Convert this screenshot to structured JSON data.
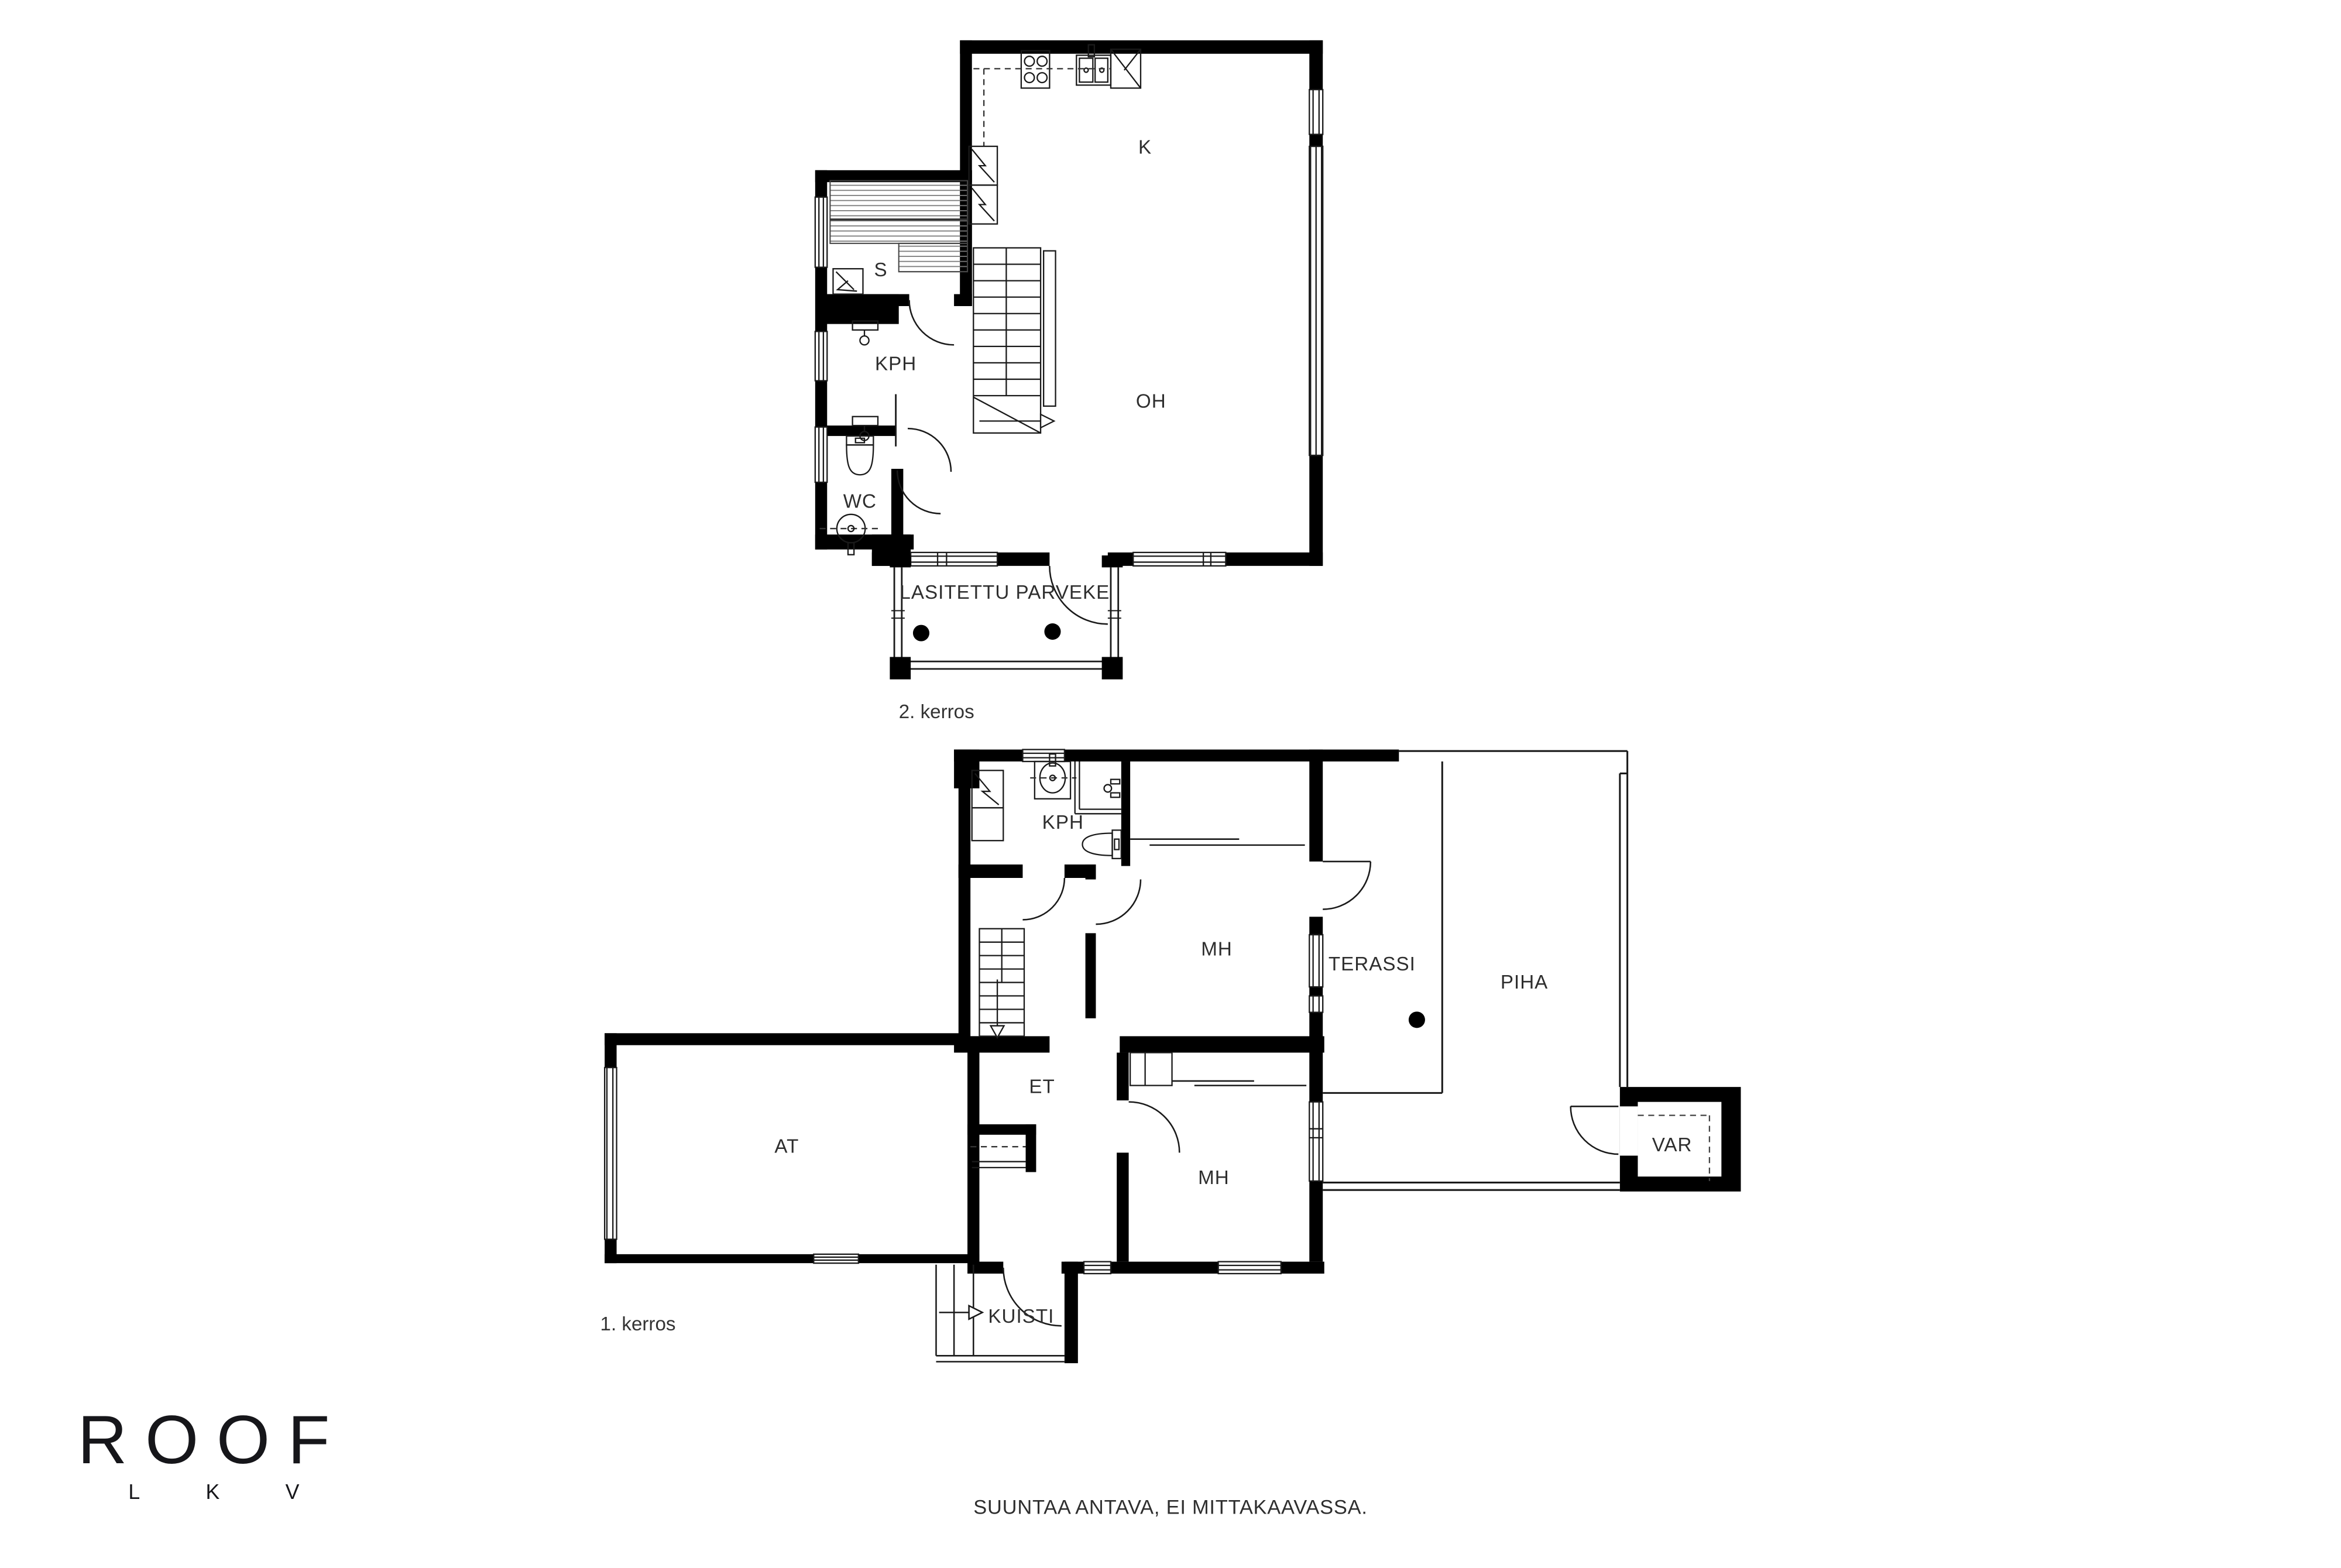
{
  "colors": {
    "wall": "#000000",
    "line": "#1a1a1a",
    "text": "#2e2e2e",
    "background": "#ffffff"
  },
  "floor2": {
    "caption": "2. kerros",
    "rooms": {
      "kitchen": "K",
      "living_room": "OH",
      "sauna": "S",
      "bathroom": "KPH",
      "wc": "WC",
      "balcony": "LASITETTU PARVEKE"
    }
  },
  "floor1": {
    "caption": "1. kerros",
    "rooms": {
      "bathroom": "KPH",
      "bedroom_upper": "MH",
      "terrace": "TERASSI",
      "yard": "PIHA",
      "hallway": "ET",
      "garage": "AT",
      "bedroom_lower": "MH",
      "storage": "VAR",
      "porch": "KUISTI"
    }
  },
  "branding": {
    "logo_text": "ROOF",
    "logo_letters": [
      "L",
      "K",
      "V"
    ]
  },
  "footer": {
    "disclaimer": "SUUNTAA ANTAVA, EI MITTAKAAVASSA."
  }
}
